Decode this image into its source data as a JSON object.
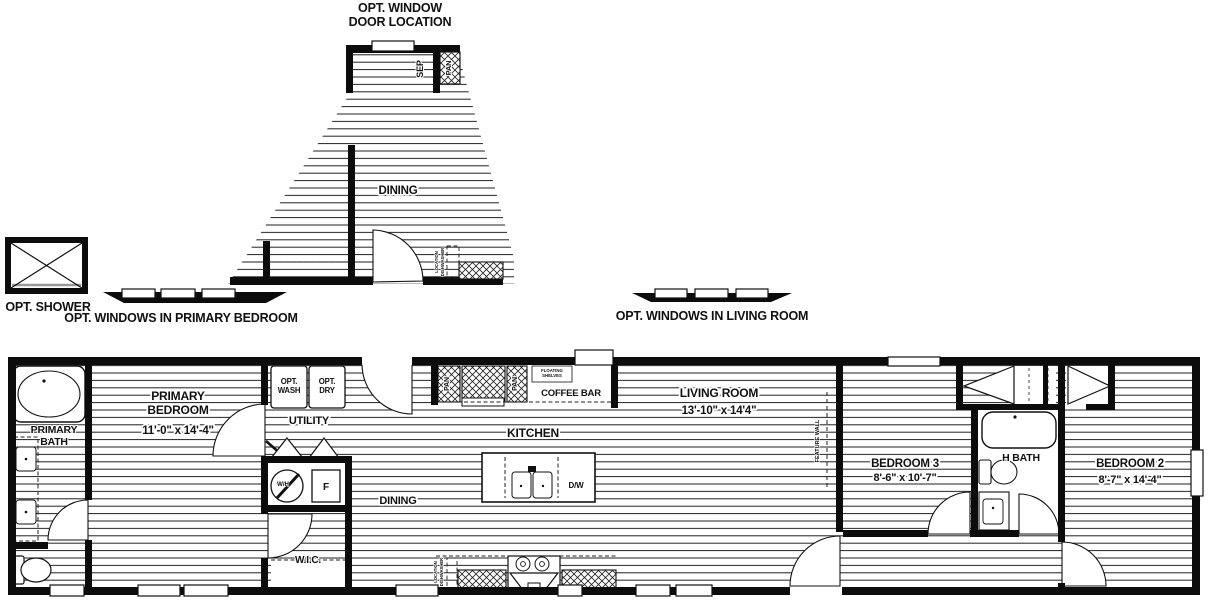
{
  "plan": {
    "options": {
      "window_door": {
        "title_line1": "OPT. WINDOW",
        "title_line2": "DOOR LOCATION",
        "room": "DINING",
        "sep": "SEP",
        "pan": "PAN"
      },
      "shower": {
        "label": "OPT. SHOWER"
      },
      "windows_primary_bedroom": {
        "label": "OPT. WINDOWS IN PRIMARY BEDROOM"
      },
      "windows_living_room": {
        "label": "OPT. WINDOWS IN LIVING ROOM"
      }
    },
    "rooms": {
      "primary_bath": {
        "name_line1": "PRIMARY",
        "name_line2": "BATH"
      },
      "primary_bedroom": {
        "name_line1": "PRIMARY",
        "name_line2": "BEDROOM",
        "dims": "11'-0\" x  14'-4\""
      },
      "utility": {
        "name": "UTILITY"
      },
      "wic": {
        "name": "W.I.C."
      },
      "dining": {
        "name": "DINING"
      },
      "kitchen": {
        "name": "KITCHEN"
      },
      "coffee_bar": {
        "name": "COFFEE BAR",
        "shelf_note_line1": "FLOATING",
        "shelf_note_line2": "SHELVES"
      },
      "living_room": {
        "name": "LIVING ROOM",
        "dims": "13'-10\" x 14'4\""
      },
      "bedroom_3": {
        "name": "BEDROOM 3",
        "dims": "8'-6\" x 10'-7\""
      },
      "h_bath": {
        "name": "H BATH"
      },
      "bedroom_2": {
        "name": "BEDROOM 2",
        "dims": "8'-7\" x 14'-4\""
      }
    },
    "fixtures": {
      "opt_wash_line1": "OPT.",
      "opt_wash_line2": "WASH",
      "opt_dry_line1": "OPT.",
      "opt_dry_line2": "DRY",
      "water_heater": "W/H",
      "furnace": "F",
      "dishwasher": "D/W",
      "pantry": "PAN",
      "feature_wall": "FEATURE WALL",
      "dishwasher_location_line1": "DISHWASHER",
      "dishwasher_location_line2": "LOCATION"
    },
    "colors": {
      "line": "#111111",
      "background": "#ffffff"
    }
  }
}
